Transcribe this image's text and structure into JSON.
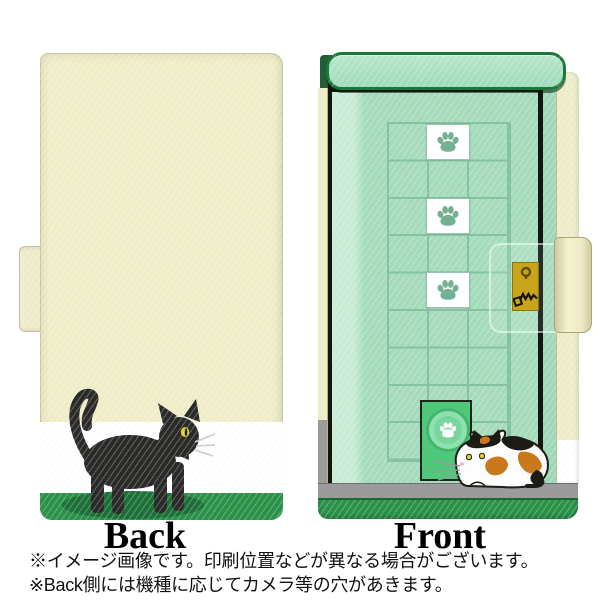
{
  "captions": {
    "back": "Back",
    "front": "Front"
  },
  "notes": [
    "※イメージ画像です。印刷位置などが異なる場合がございます。",
    "※Back側には機種に応じてカメラ等の穴があきます。"
  ],
  "icons": [
    "paw-print-icon",
    "keyhole-icon",
    "key-icon"
  ],
  "colors": {
    "case_cream": "#efecca",
    "door_green": "#a5dcbc",
    "grass_green": "#2a9249",
    "cat_door_green": "#4fc87c",
    "grid_line_green": "#86c2a4",
    "floor_gray": "#9b9b9b",
    "gold_clasp": "#c8a51b",
    "black_cat": "#2a2a28",
    "calico_orange": "#c9791c",
    "eye_yellow": "#e3cf2b"
  }
}
